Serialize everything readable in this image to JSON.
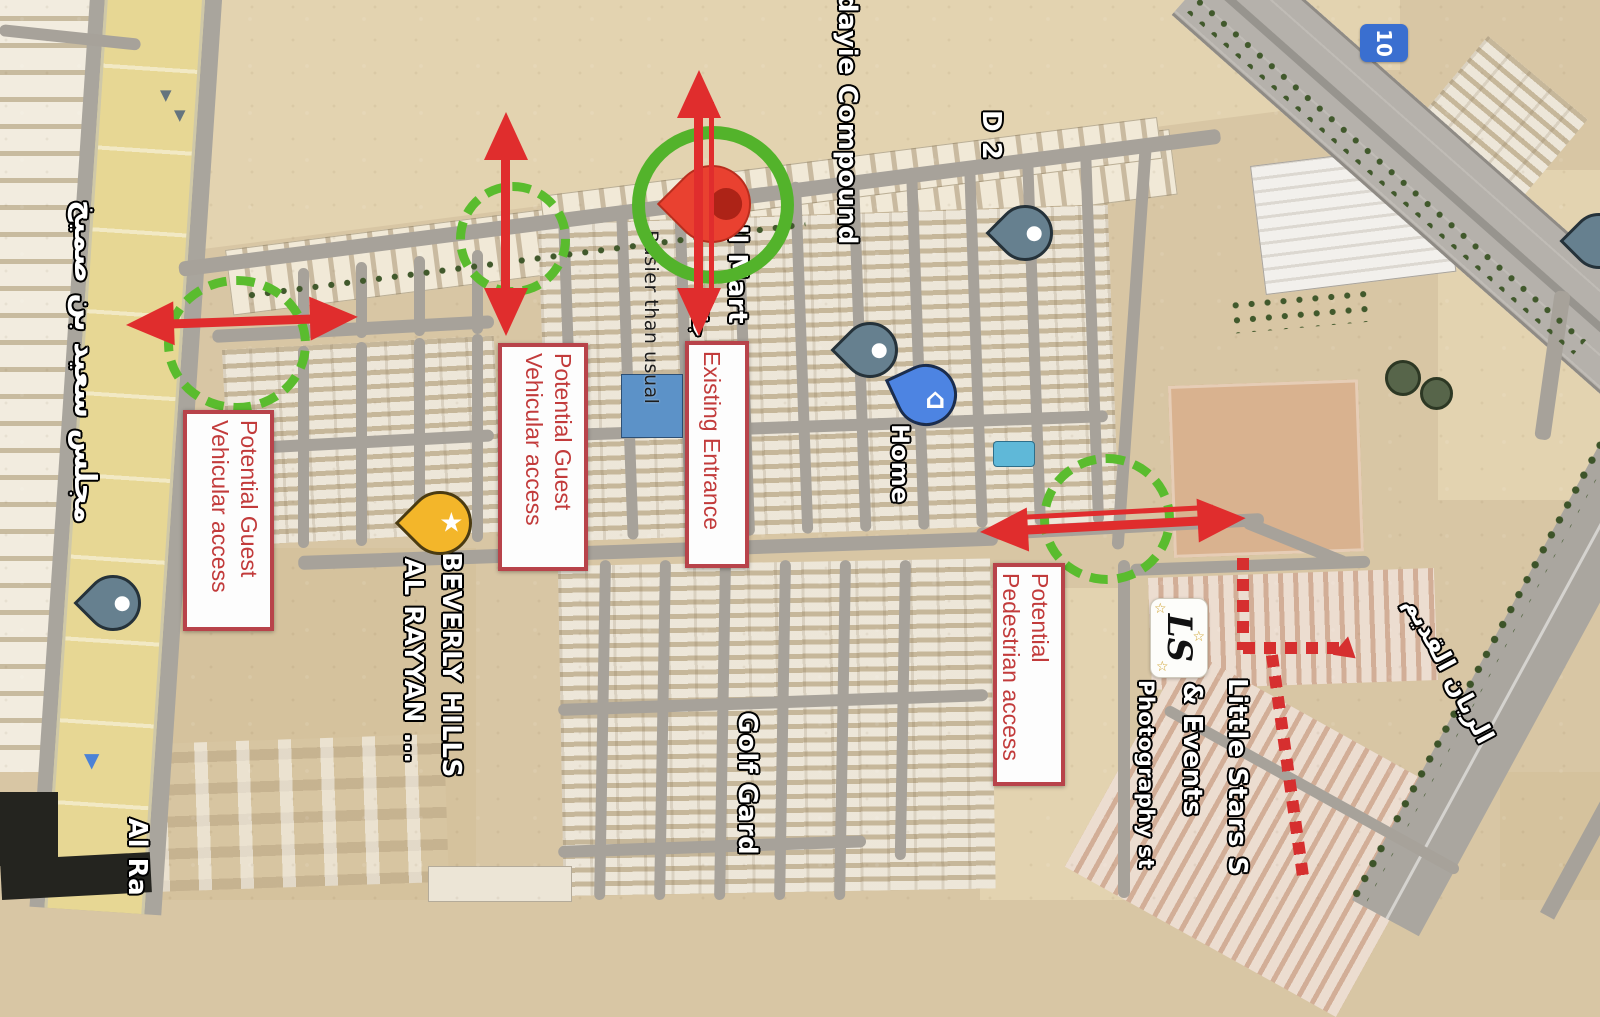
{
  "annotation_boxes": [
    {
      "lines": [
        "Potential Guest",
        "Vehicular access"
      ]
    },
    {
      "lines": [
        "Potential Guest",
        "Vehicular access"
      ]
    },
    {
      "lines": [
        "Existing Entrance"
      ]
    },
    {
      "lines": [
        "Potential",
        "Pedestrian access"
      ]
    }
  ],
  "map_labels": {
    "busier": "Busier than usual",
    "mart": "ll Mart",
    "mart_arabic": "جال",
    "compound": "dayie Compound",
    "d2": "D 2",
    "home": "Home",
    "beverly_1": "BEVERLY HILLS",
    "beverly_2": "AL RAYYAN ...",
    "golf": "Golf Gard",
    "little_1": "Little Stars S",
    "little_2": "& Events",
    "little_3": "Photography st",
    "majlis_arabic": "مجلس سعيد بن صميخ",
    "al_ra": "Al Ra",
    "rayyan_old_arabic": "الريان القديم",
    "route_number": "10",
    "ls_logo_text": "LS"
  },
  "markers": [
    {
      "name": "existing-entrance-pin",
      "type": "red-map-pin"
    },
    {
      "name": "d2-pin",
      "type": "blue-dot-pin"
    },
    {
      "name": "compound-pin",
      "type": "blue-dot-pin"
    },
    {
      "name": "home-pin",
      "type": "blue-house-pin"
    },
    {
      "name": "left-road-pin",
      "type": "blue-dot-pin"
    },
    {
      "name": "beverly-hills-pin",
      "type": "yellow-star-pin"
    },
    {
      "name": "edge-pin",
      "type": "blue-dot-pin"
    }
  ],
  "colors": {
    "arrow_red": "#e02d2d",
    "box_border": "#b8434a",
    "box_text": "#c23b3b",
    "green_ring": "#53b32b",
    "green_dashed": "#5abc2e",
    "dashed_path": "#d62f2f",
    "pin_red": "#e94130",
    "pin_blue": "#4d84e2",
    "pin_gray_blue": "#66808f",
    "pin_yellow": "#f3b62a"
  }
}
